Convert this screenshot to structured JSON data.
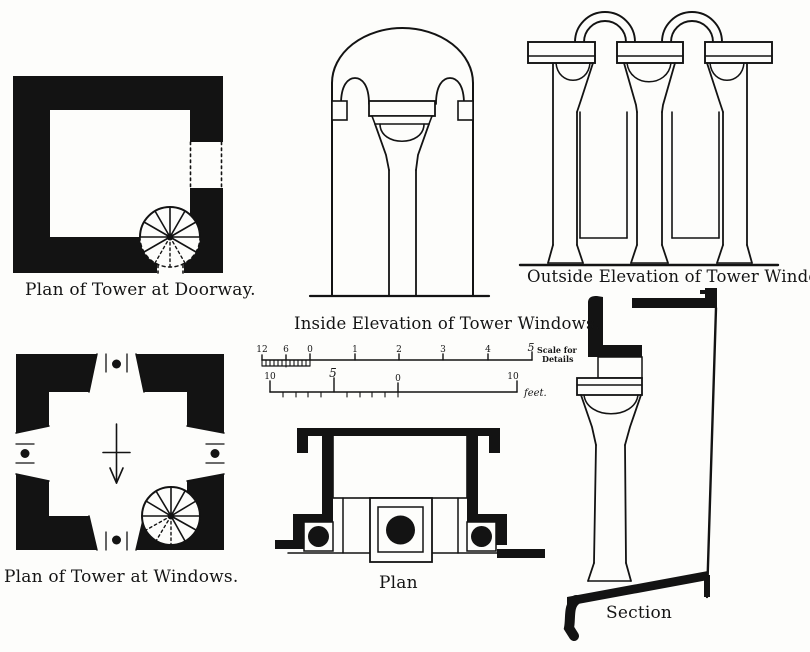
{
  "palette": {
    "paper": "#fdfdfb",
    "ink": "#131313"
  },
  "figures": {
    "plan_doorway": {
      "caption": "Plan of Tower at Doorway."
    },
    "plan_windows": {
      "caption": "Plan of Tower at Windows."
    },
    "inside_elevation": {
      "caption": "Inside Elevation of Tower Windows."
    },
    "outside_elevation": {
      "caption": "Outside Elevation of Tower Windows."
    },
    "window_plan": {
      "caption": "Plan"
    },
    "window_section": {
      "caption": "Section"
    }
  },
  "scale_bar": {
    "details": {
      "tick_labels": [
        "12",
        "6",
        "0",
        "1",
        "2",
        "3",
        "4",
        "5"
      ],
      "caption_line1": "Scale for",
      "caption_line2": "Details"
    },
    "feet": {
      "tick_labels": [
        "10",
        "5",
        "0",
        "10"
      ],
      "unit": "feet."
    }
  }
}
